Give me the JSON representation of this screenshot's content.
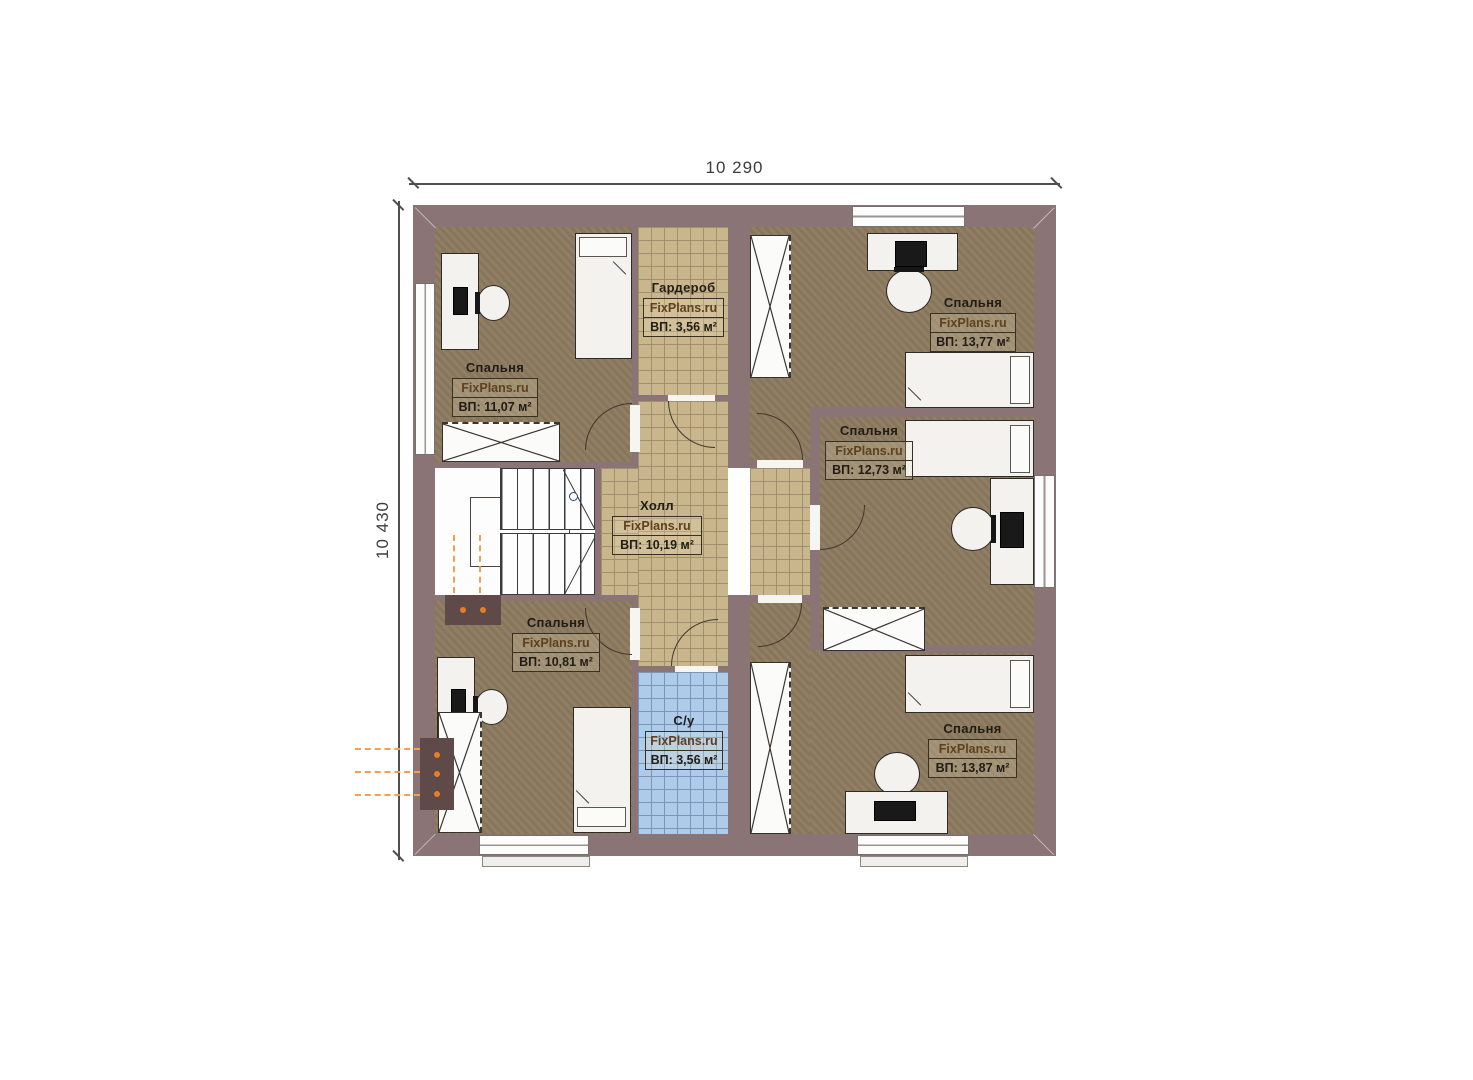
{
  "dimensions": {
    "width_label": "10 290",
    "height_label": "10 430"
  },
  "rooms": [
    {
      "id": "bedroom-top-left",
      "name": "Спальня",
      "watermark": "FixPlans.ru",
      "area": "ВП: 11,07 м²"
    },
    {
      "id": "wardrobe",
      "name": "Гардероб",
      "watermark": "FixPlans.ru",
      "area": "ВП: 3,56 м²"
    },
    {
      "id": "bedroom-top-right",
      "name": "Спальня",
      "watermark": "FixPlans.ru",
      "area": "ВП: 13,77 м²"
    },
    {
      "id": "bedroom-mid-right",
      "name": "Спальня",
      "watermark": "FixPlans.ru",
      "area": "ВП: 12,73 м²"
    },
    {
      "id": "hall",
      "name": "Холл",
      "watermark": "FixPlans.ru",
      "area": "ВП: 10,19 м²"
    },
    {
      "id": "bedroom-bottom-left",
      "name": "Спальня",
      "watermark": "FixPlans.ru",
      "area": "ВП: 10,81 м²"
    },
    {
      "id": "bathroom",
      "name": "С/у",
      "watermark": "FixPlans.ru",
      "area": "ВП: 3,56 м²"
    },
    {
      "id": "bedroom-bottom-right",
      "name": "Спальня",
      "watermark": "FixPlans.ru",
      "area": "ВП: 13,87 м²"
    }
  ],
  "colors": {
    "wall": "#8a7476",
    "bedroom_floor": "#8c7b5f",
    "hall_floor": "#c9b68d",
    "bathroom_floor": "#aecce9",
    "radiator": "#e87e22"
  }
}
